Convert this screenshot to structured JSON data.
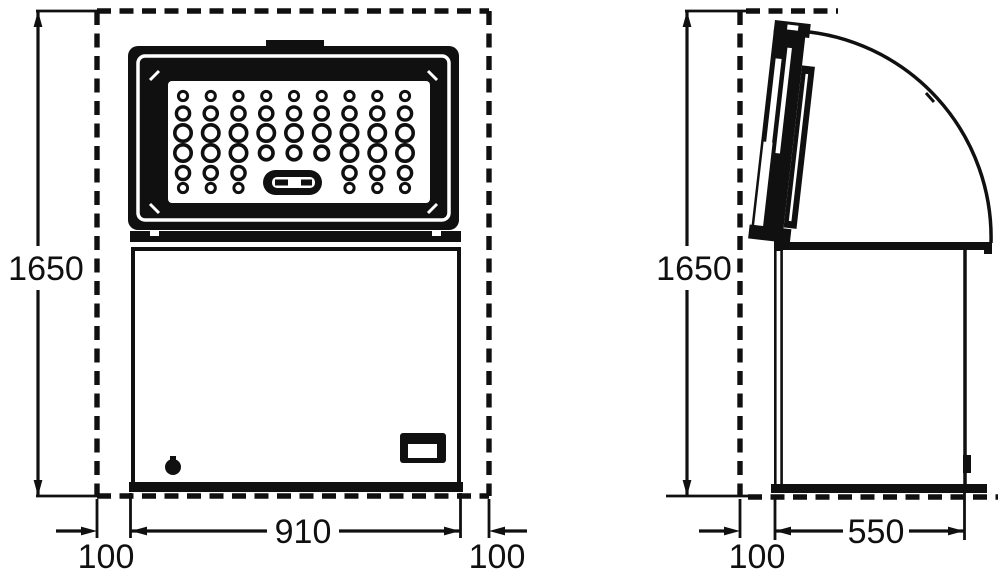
{
  "diagram": {
    "views": {
      "front": {
        "height": "1650",
        "width": "910",
        "clearance_left": "100",
        "clearance_right": "100"
      },
      "side": {
        "height": "1650",
        "depth": "550",
        "clearance_rear": "100"
      }
    },
    "colors": {
      "ink": "#101010",
      "background": "#ffffff"
    }
  }
}
